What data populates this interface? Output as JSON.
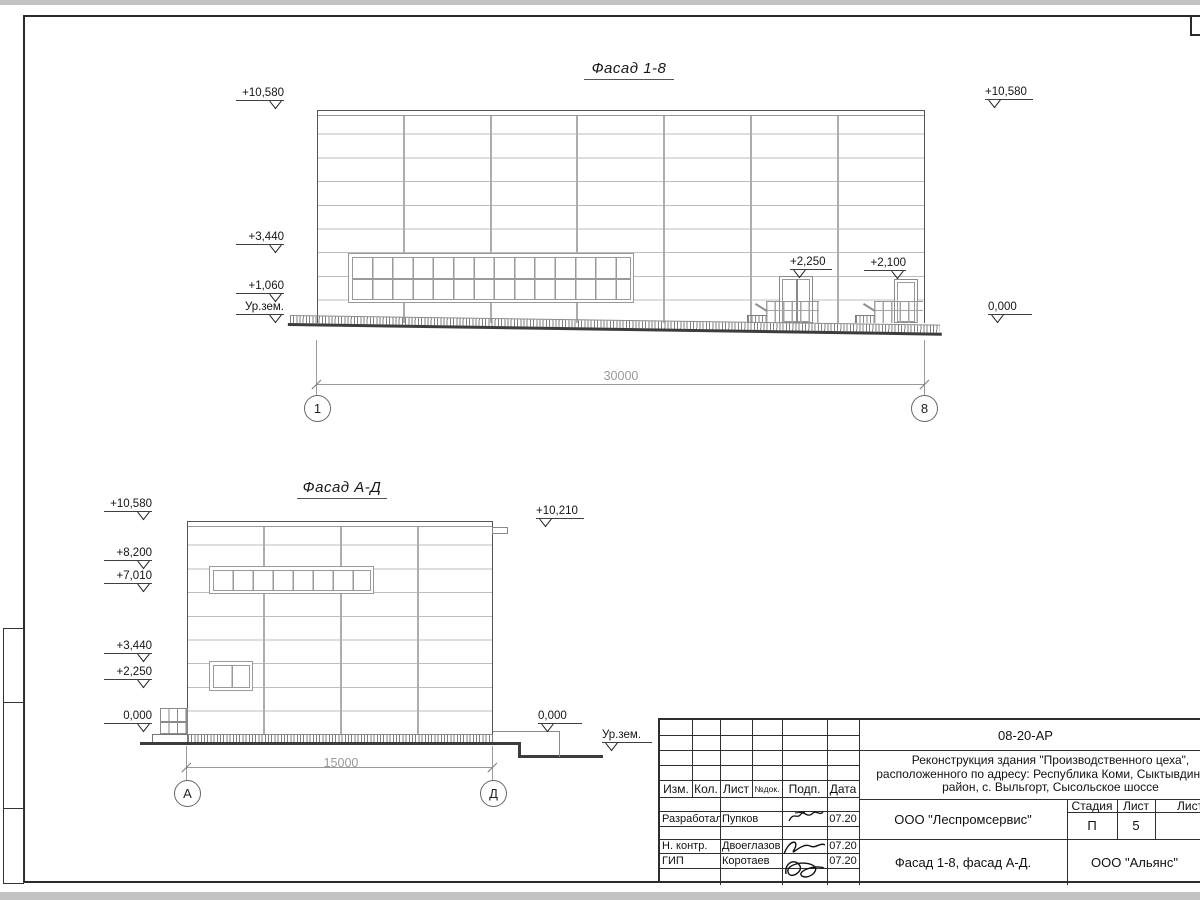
{
  "colors": {
    "line_dark": "#2e2e2e",
    "line_mid": "#8a8a8a",
    "line_light": "#bdbdbd",
    "dim_gray": "#9a9a9a",
    "paper": "#ffffff"
  },
  "facade1": {
    "title": "Фасад 1-8",
    "marks": {
      "left_top": "+10,580",
      "left_3440": "+3,440",
      "left_1060": "+1,060",
      "left_ground": "Ур.зем.",
      "right_top": "+10,580",
      "right_zero": "0,000",
      "door1": "+2,250",
      "door2": "+2,100"
    },
    "dim": "30000",
    "axis_left": "1",
    "axis_right": "8"
  },
  "facade2": {
    "title": "Фасад А-Д",
    "marks": {
      "left_top": "+10,580",
      "left_8200": "+8,200",
      "left_7010": "+7,010",
      "left_3440": "+3,440",
      "left_2250": "+2,250",
      "left_zero": "0,000",
      "right_top": "+10,210",
      "right_zero": "0,000",
      "right_ground": "Ур.зем."
    },
    "dim": "15000",
    "axis_left": "А",
    "axis_right": "Д"
  },
  "titleblock": {
    "doc_number": "08-20-АР",
    "project_line1": "Реконструкция здания \"Производственного цеха\",",
    "project_line2": "расположенного по адресу: Республика Коми, Сыктывдинский",
    "project_line3": "район, с. Выльгорт, Сысольское шоссе",
    "header": {
      "izm": "Изм.",
      "kol": "Кол.",
      "list": "Лист",
      "doc": "№док.",
      "podp": "Подп.",
      "data": "Дата"
    },
    "rows": [
      {
        "role": "Разработал",
        "name": "Пупков",
        "date": "07.20"
      },
      {
        "role": "Н. контр.",
        "name": "Двоеглазов",
        "date": "07.20"
      },
      {
        "role": "ГИП",
        "name": "Коротаев",
        "date": "07.20"
      }
    ],
    "org_design": "ООО \"Леспромсервис\"",
    "stage_label": "Стадия",
    "sheet_label": "Лист",
    "sheets_label": "Листов",
    "stage": "П",
    "sheet_num": "5",
    "sheet_title": "Фасад 1-8, фасад А-Д.",
    "org_customer": "ООО \"Альянс\""
  }
}
